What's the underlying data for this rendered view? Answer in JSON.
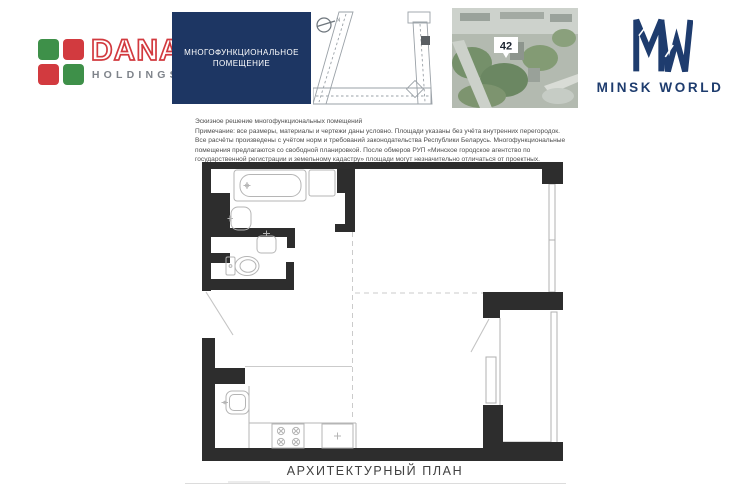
{
  "colors": {
    "navy": "#1d3663",
    "mw-navy": "#1e3c6e",
    "logo-red": "#d23a3f",
    "logo-green": "#3e9049",
    "holdings-gray": "#7e838a",
    "wall": "#2d2d2d",
    "line": "#b5b5b5",
    "dash": "#cbcbcb",
    "text-gray": "#4d4d4d",
    "footer-gray": "#414141"
  },
  "header": {
    "dana_logo": {
      "title": "DANA",
      "subtitle": "HOLDINGS"
    },
    "unit_type_box": {
      "line1": "МНОГОФУНКЦИОНАЛЬНОЕ",
      "line2": "ПОМЕЩЕНИЕ"
    },
    "floor_key_plan": {
      "north_label": "N"
    },
    "site_photo": {
      "building_number": "42"
    },
    "brand_logo": {
      "monogram": "MW",
      "title": "MINSK WORLD"
    }
  },
  "notes": {
    "line1": "Эскизное решение многофункциональных помещений",
    "line2": "Примечание: все размеры, материалы и чертежи даны условно. Площади указаны без учёта внутренних перегородок.",
    "line3": "Все расчёты произведены с учётом норм и требований законодательства Республики Беларусь. Многофункциональные",
    "line4": "помещения предлагаются со свободной планировкой. После обмеров РУП «Минское городское агентство по",
    "line5": "государственной регистрации и земельному кадастру» площади могут незначительно отличаться от проектных."
  },
  "footer": {
    "title": "АРХИТЕКТУРНЫЙ ПЛАН"
  }
}
